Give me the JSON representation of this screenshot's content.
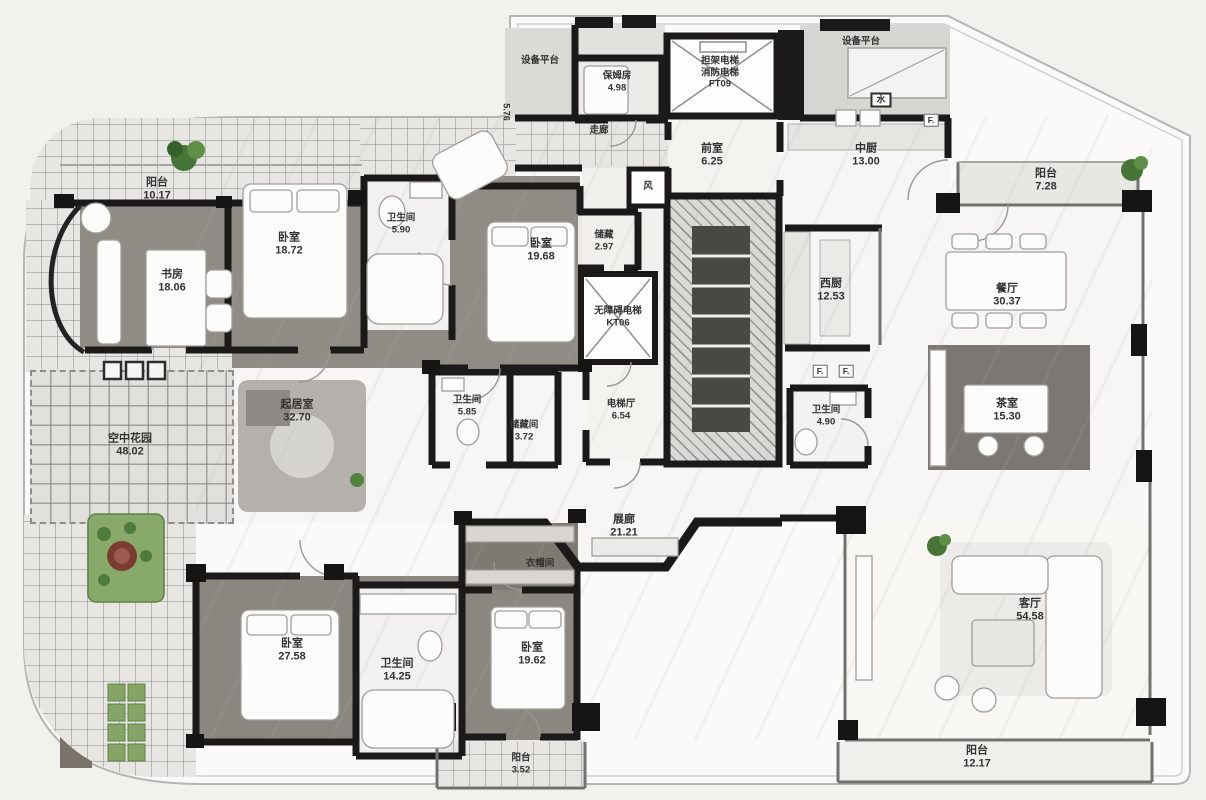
{
  "palette": {
    "wall": "#1b1a19",
    "wood_floor": "#8f8b85",
    "marble": "#f7f6f4",
    "tile": "#e8e6e2",
    "dark_room": "#7b7772",
    "plant_green": "#477537",
    "plant_red": "#7c3b31"
  },
  "rooms": {
    "balcony_tl": {
      "name": "阳台",
      "area": "10.17"
    },
    "study": {
      "name": "书房",
      "area": "18.06"
    },
    "bedroom1": {
      "name": "卧室",
      "area": "18.72"
    },
    "bath1": {
      "name": "卫生间",
      "area": "5.90"
    },
    "bedroom2": {
      "name": "卧室",
      "area": "19.68"
    },
    "storage1": {
      "name": "储藏",
      "area": "2.97"
    },
    "nanny": {
      "name": "保姆房",
      "area": "4.98"
    },
    "corridor": {
      "name": "走廊",
      "area": "5.76"
    },
    "vestibule": {
      "name": "前室",
      "area": "6.25"
    },
    "kitchen_cn": {
      "name": "中厨",
      "area": "13.00"
    },
    "balcony_tr": {
      "name": "阳台",
      "area": "7.28"
    },
    "kitchen_w": {
      "name": "西厨",
      "area": "12.53"
    },
    "dining": {
      "name": "餐厅",
      "area": "30.37"
    },
    "family": {
      "name": "起居室",
      "area": "32.70"
    },
    "bath2": {
      "name": "卫生间",
      "area": "5.85"
    },
    "storage2": {
      "name": "储藏间",
      "area": "3.72"
    },
    "lift_hall": {
      "name": "电梯厅",
      "area": "6.54"
    },
    "bath3": {
      "name": "卫生间",
      "area": "4.90"
    },
    "tea": {
      "name": "茶室",
      "area": "15.30"
    },
    "garden": {
      "name": "空中花园",
      "area": "48.02"
    },
    "gallery": {
      "name": "展廊",
      "area": "21.21"
    },
    "cloak": {
      "name": "衣帽间",
      "area": ""
    },
    "bedroom3": {
      "name": "卧室",
      "area": "27.58"
    },
    "bath4": {
      "name": "卫生间",
      "area": "14.25"
    },
    "bedroom4": {
      "name": "卧室",
      "area": "19.62"
    },
    "living": {
      "name": "客厅",
      "area": "54.58"
    },
    "balcony_br": {
      "name": "阳台",
      "area": "12.17"
    },
    "balcony_bc": {
      "name": "阳台",
      "area": "3.52"
    }
  },
  "shafts": {
    "ft09_line1": "担架电梯",
    "ft09_line2": "消防电梯",
    "ft09_code": "FT09",
    "kt06_line1": "无障碍电梯",
    "kt06_code": "KT06"
  },
  "platforms": {
    "left": "设备平台",
    "right": "设备平台"
  },
  "marks": {
    "vent": "风",
    "water": "水",
    "f1": "F.",
    "f2": "F.",
    "f3": "F."
  }
}
